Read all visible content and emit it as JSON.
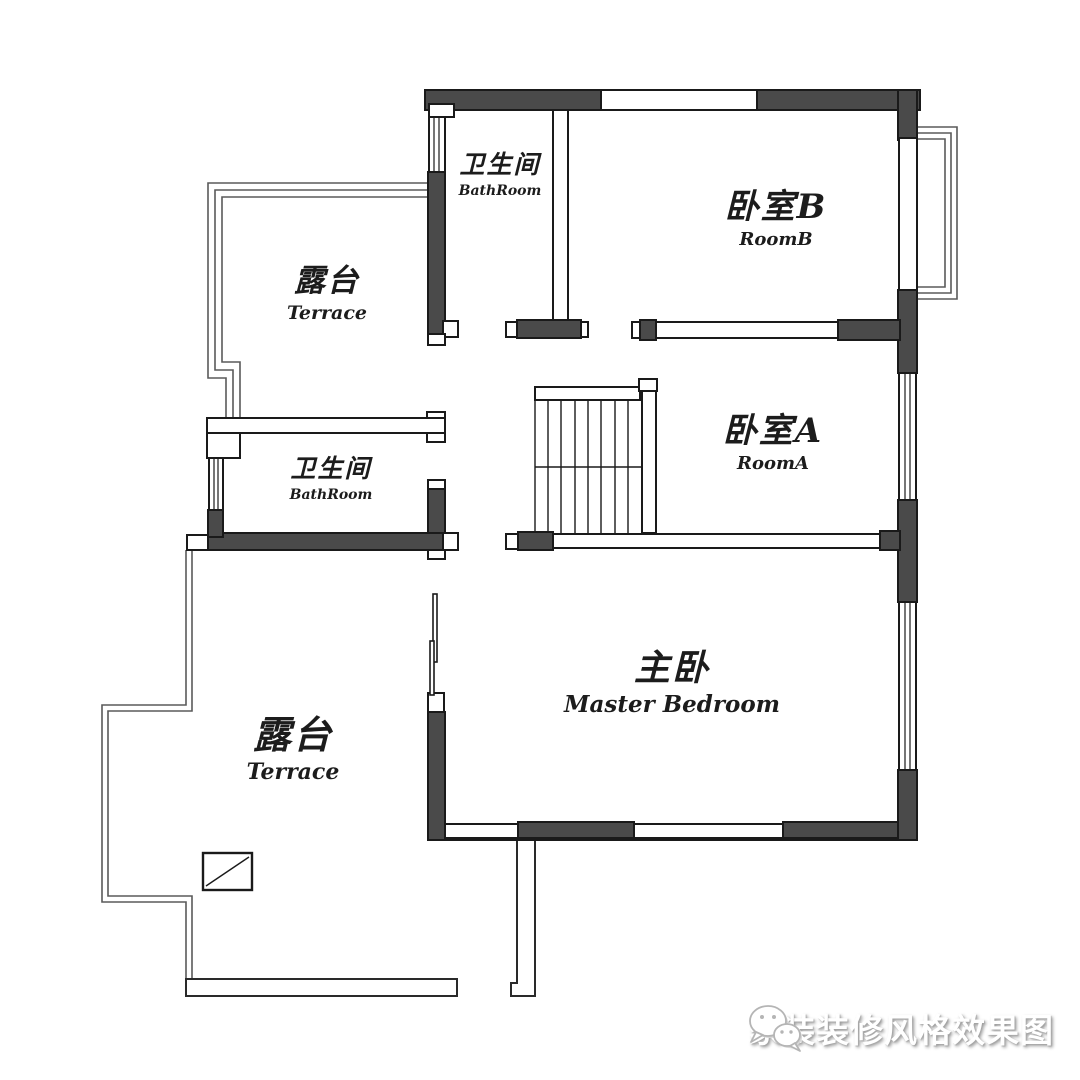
{
  "title": "second-floor-plan",
  "colors": {
    "wall_fill": "#4a4a4a",
    "outline": "#1a1a1a",
    "thin_line": "#5a5a5a",
    "background": "#ffffff",
    "watermark_text": "#ffffff",
    "watermark_shadow": "#9b9b9b"
  },
  "rooms": [
    {
      "id": "bathroom-top",
      "zh": "卫生间",
      "en": "BathRoom"
    },
    {
      "id": "bedroom-b",
      "zh": "卧室B",
      "en": "RoomB"
    },
    {
      "id": "terrace-upper",
      "zh": "露台",
      "en": "Terrace"
    },
    {
      "id": "bedroom-a",
      "zh": "卧室A",
      "en": "RoomA"
    },
    {
      "id": "bathroom-left",
      "zh": "卫生间",
      "en": "BathRoom"
    },
    {
      "id": "master-bedroom",
      "zh": "主卧",
      "en": "Master Bedroom"
    },
    {
      "id": "terrace-lower",
      "zh": "露台",
      "en": "Terrace"
    }
  ],
  "watermark": {
    "icon": "wechat-icon",
    "text": "家装装修风格效果图"
  }
}
